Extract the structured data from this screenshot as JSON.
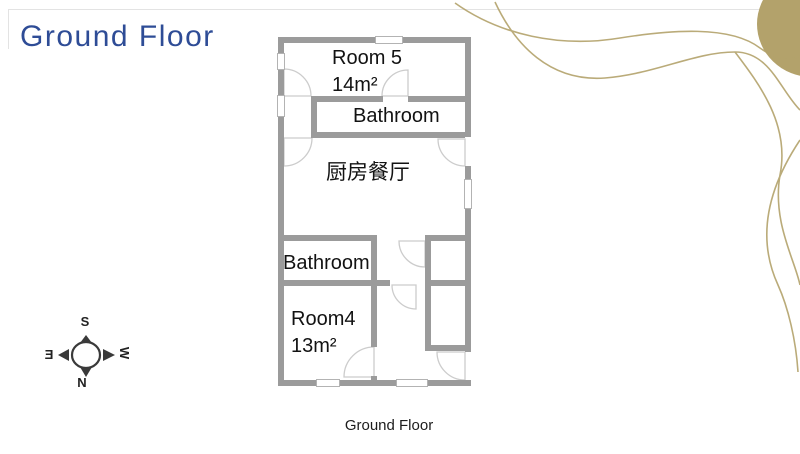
{
  "slide": {
    "title": "Ground Floor",
    "caption": "Ground Floor",
    "title_color": "#2E4C96",
    "gold_accent": "#B3A26B"
  },
  "compass": {
    "top": "S",
    "bottom": "N",
    "left": "E",
    "right": "W"
  },
  "floor_plan": {
    "wall_color": "#9B9B9B",
    "rooms": {
      "room5": {
        "label": "Room 5",
        "area": "14m²"
      },
      "bathroom_top": {
        "label": "Bathroom"
      },
      "kitchen": {
        "label": "厨房餐厅"
      },
      "bathroom_bottom": {
        "label": "Bathroom"
      },
      "room4": {
        "label": "Room4",
        "area": "13m²"
      }
    },
    "walls": [
      [
        278,
        37,
        97,
        6
      ],
      [
        403,
        37,
        68,
        6
      ],
      [
        278,
        37,
        6,
        16
      ],
      [
        278,
        70,
        6,
        25
      ],
      [
        278,
        117,
        6,
        269
      ],
      [
        465,
        37,
        6,
        100
      ],
      [
        465,
        166,
        6,
        13
      ],
      [
        465,
        209,
        6,
        143
      ],
      [
        465,
        380,
        6,
        6
      ],
      [
        278,
        380,
        38,
        6
      ],
      [
        340,
        380,
        56,
        6
      ],
      [
        428,
        380,
        43,
        6
      ],
      [
        311,
        96,
        72,
        6
      ],
      [
        408,
        96,
        57,
        6
      ],
      [
        311,
        96,
        6,
        42
      ],
      [
        311,
        132,
        154,
        6
      ],
      [
        278,
        235,
        99,
        6
      ],
      [
        425,
        235,
        40,
        6
      ],
      [
        371,
        235,
        6,
        112
      ],
      [
        371,
        376,
        6,
        6
      ],
      [
        278,
        280,
        112,
        6
      ],
      [
        425,
        280,
        40,
        6
      ],
      [
        425,
        235,
        6,
        116
      ],
      [
        425,
        345,
        40,
        6
      ]
    ],
    "windows": [
      [
        375,
        36,
        28,
        8
      ],
      [
        277,
        53,
        8,
        17
      ],
      [
        277,
        95,
        8,
        22
      ],
      [
        464,
        179,
        8,
        30
      ],
      [
        316,
        379,
        24,
        8
      ],
      [
        396,
        379,
        32,
        8
      ]
    ],
    "doors": [
      {
        "cx": 284,
        "cy": 96,
        "r": 27,
        "dir": "up-right"
      },
      {
        "cx": 408,
        "cy": 96,
        "r": 26,
        "dir": "up-left"
      },
      {
        "cx": 284,
        "cy": 138,
        "r": 28,
        "dir": "down-right"
      },
      {
        "cx": 465,
        "cy": 139,
        "r": 27,
        "dir": "down-left"
      },
      {
        "cx": 425,
        "cy": 241,
        "r": 26,
        "dir": "down-left"
      },
      {
        "cx": 416,
        "cy": 285,
        "r": 24,
        "dir": "down-left"
      },
      {
        "cx": 374,
        "cy": 377,
        "r": 30,
        "dir": "up-left"
      },
      {
        "cx": 465,
        "cy": 352,
        "r": 28,
        "dir": "down-left"
      }
    ]
  }
}
